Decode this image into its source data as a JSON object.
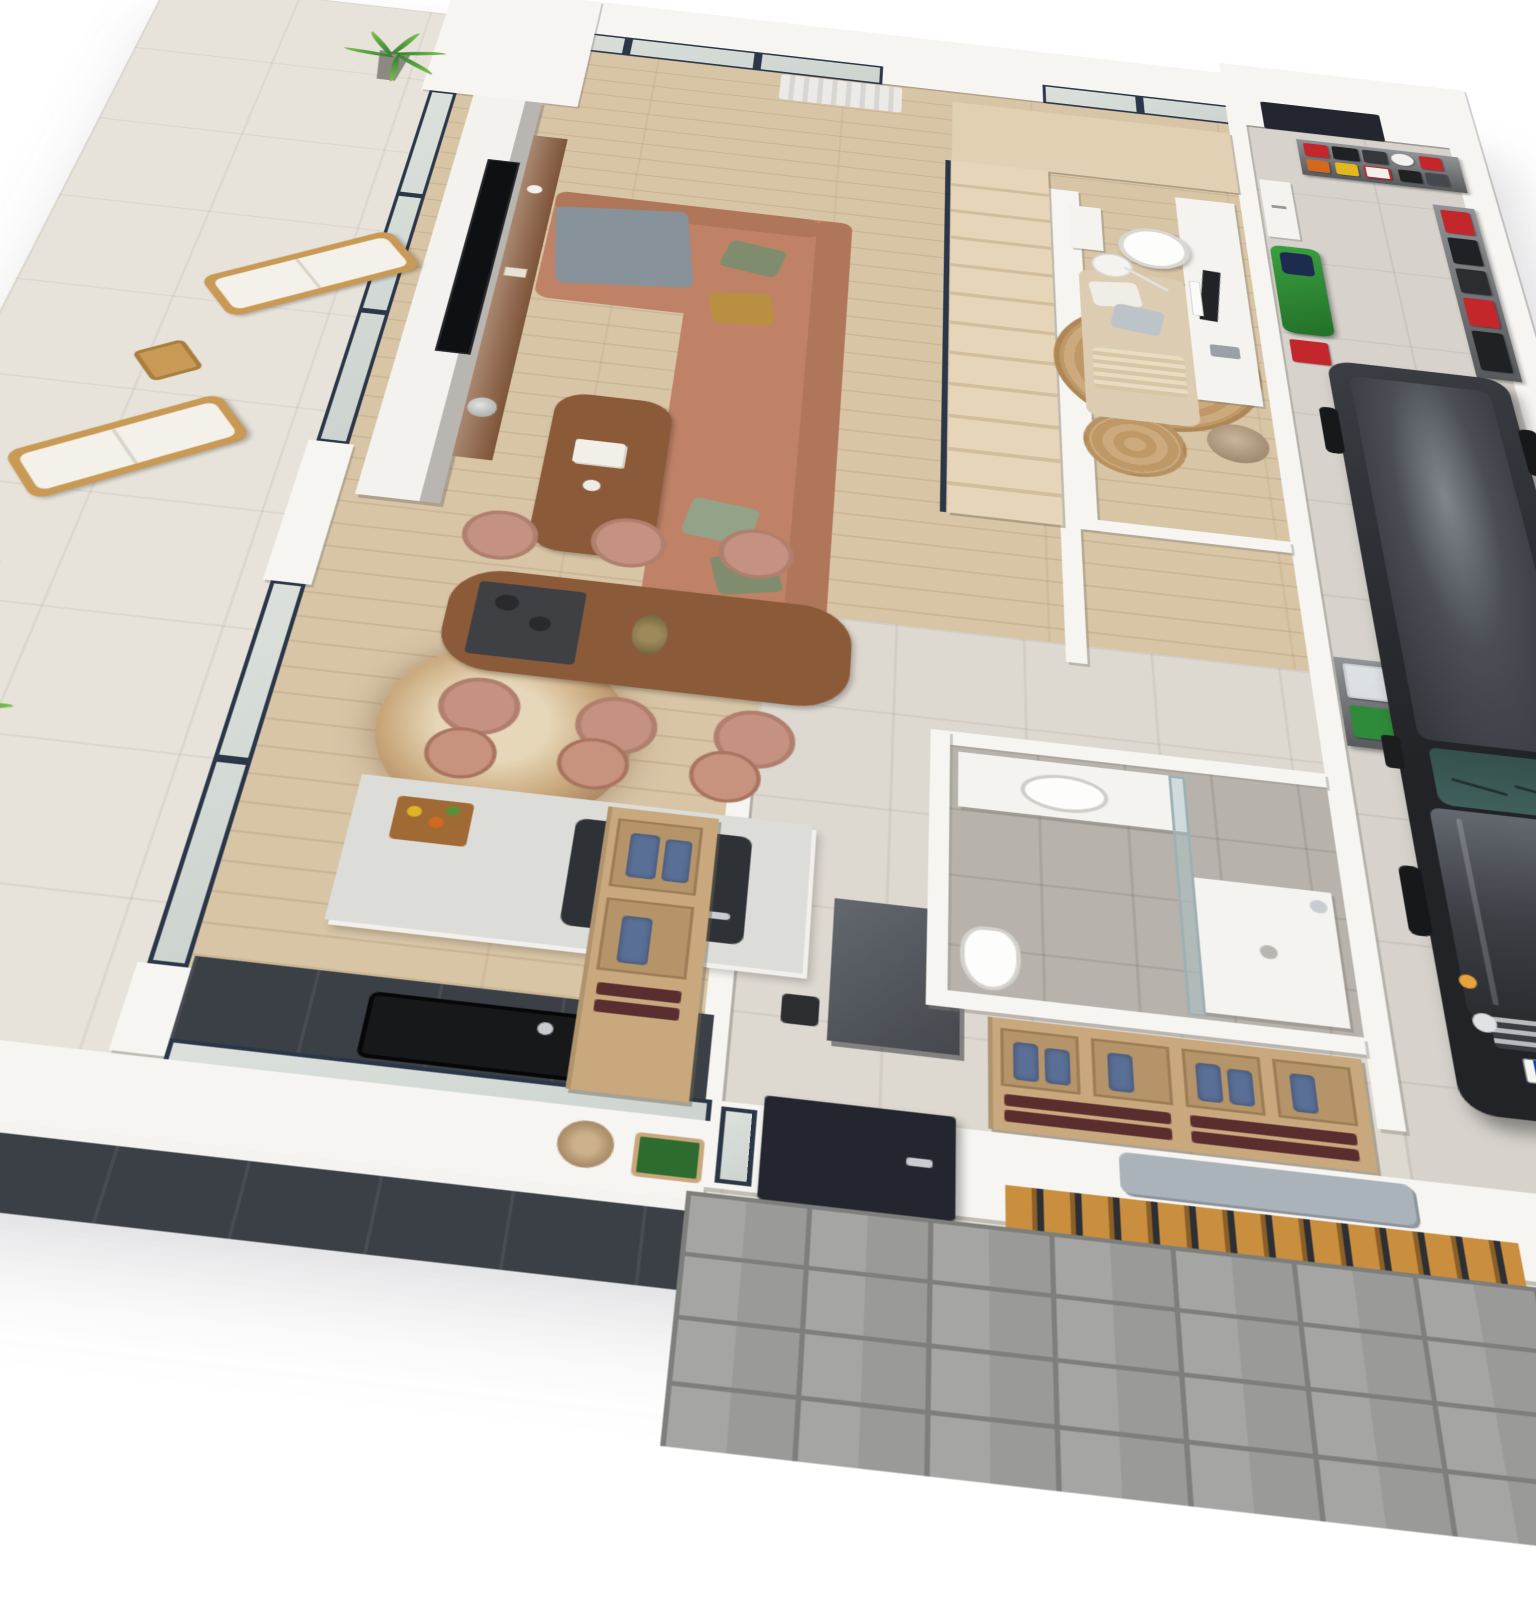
{
  "meta": {
    "type": "3D isometric dollhouse floor-plan rendering",
    "storeys": "single floor cutaway, white cut walls, white background",
    "camera": "axonometric from above, rotated ~7 degrees"
  },
  "license_plate": {
    "text": "VIZ-PEOP",
    "eu_strip_color": "#1b3f9e"
  },
  "palette": {
    "background": "#ffffff",
    "terrace_tile": "#e7e3db",
    "wood_floor": "#d8c5a6",
    "hall_tile": "#ddd8d0",
    "bath_tile": "#b7b2ab",
    "garage_concrete": "#d7d3cc",
    "cut_wall_white": "#f6f5f2",
    "window_frame_navy": "#2b3648",
    "door_anthracite": "#23262e",
    "sofa_terracotta": "#bf8266",
    "pillow_green": "#7f8d6e",
    "pillow_mustard": "#b98f41",
    "throw_gray": "#87929a",
    "table_walnut": "#8a5a39",
    "chair_blush": "#c59180",
    "island_terrazzo": "#dcdcd8",
    "cabinet_anthracite": "#3b4046",
    "wardrobe_oak": "#c8a87c",
    "towel_blue": "#5a6f96",
    "rug_jute": "#c9a87b",
    "car_black": "#26282c",
    "windshield_teal": "#40605c",
    "mower_green": "#2f8f35",
    "crate_green": "#2e8b3a",
    "box_red": "#c3272b",
    "bin_blue": "#2247b8",
    "jerrycan_orange": "#d2691e",
    "jerrycan_yellow": "#e3b71f",
    "slat_fence_tan": "#c98f3f",
    "paver_gray": "#9e9e9c"
  },
  "rooms": [
    {
      "id": "terrace",
      "label": "Terrace",
      "floor": "light stone tiles"
    },
    {
      "id": "living-room",
      "label": "Living room",
      "floor": "light oak planks"
    },
    {
      "id": "dining-area",
      "label": "Dining area",
      "floor": "light oak planks"
    },
    {
      "id": "kitchen",
      "label": "Kitchen",
      "floor": "light oak planks"
    },
    {
      "id": "staircase",
      "label": "Staircase with landing",
      "floor": "oak treads"
    },
    {
      "id": "office-nook",
      "label": "Home office / lounge nook",
      "floor": "light oak planks"
    },
    {
      "id": "hallway",
      "label": "Hallway",
      "floor": "pale ceramic tile"
    },
    {
      "id": "bathroom",
      "label": "Bathroom",
      "floor": "gray stone tile"
    },
    {
      "id": "entry",
      "label": "Entry / mudroom",
      "floor": "pale ceramic tile"
    },
    {
      "id": "garage",
      "label": "Garage",
      "floor": "gray concrete tile"
    },
    {
      "id": "driveway",
      "label": "Entry path",
      "floor": "gray pavers"
    }
  ],
  "furniture": {
    "terrace": [
      "two wooden sun loungers with white cushions",
      "two wooden side tables",
      "two potted green plants in gray vases"
    ],
    "living_room": [
      "freestanding TV partition wall with flat TV",
      "walnut media console with vase, books and bust sculpture",
      "terracotta L-shaped sofa with green and mustard pillows and gray throw",
      "walnut coffee table with books and cups",
      "large dried pampas arrangement",
      "white curtain at glass wall"
    ],
    "dining_area": [
      "walnut dining table",
      "six blush upholstered chairs",
      "dark runner with bowls",
      "vase with dried flowers"
    ],
    "kitchen": [
      "terrazzo island with induction hob and steel pot",
      "cutting board with fruit",
      "three blush bar stools",
      "anthracite lower cabinets with black sink",
      "pass-through window to white outdoor counter",
      "dark gray tall cabinet",
      "plants on outdoor counter"
    ],
    "office_nook": [
      "white desk with monitor and keyboard",
      "white office chair",
      "beige daybed with pillows",
      "round jute rugs",
      "white floor lamp",
      "small white shelf",
      "potted dried plant"
    ],
    "bathroom": [
      "white vanity with oval sink",
      "walk-in shower with glass panel",
      "toilet"
    ],
    "entry": [
      "anthracite front door with sidelight",
      "oak open wardrobes with blue jackets and towels",
      "gray bench cushion",
      "wooden slat fence",
      "gray paver path"
    ],
    "garage": [
      "black Mercedes G-Class SUV",
      "metal shelving with red and black storage boxes, helmet, jerry cans",
      "shelving with clear bins and green crates",
      "white wall boiler",
      "white chest freezer",
      "green ride-on lawn mower",
      "navy side door"
    ]
  }
}
